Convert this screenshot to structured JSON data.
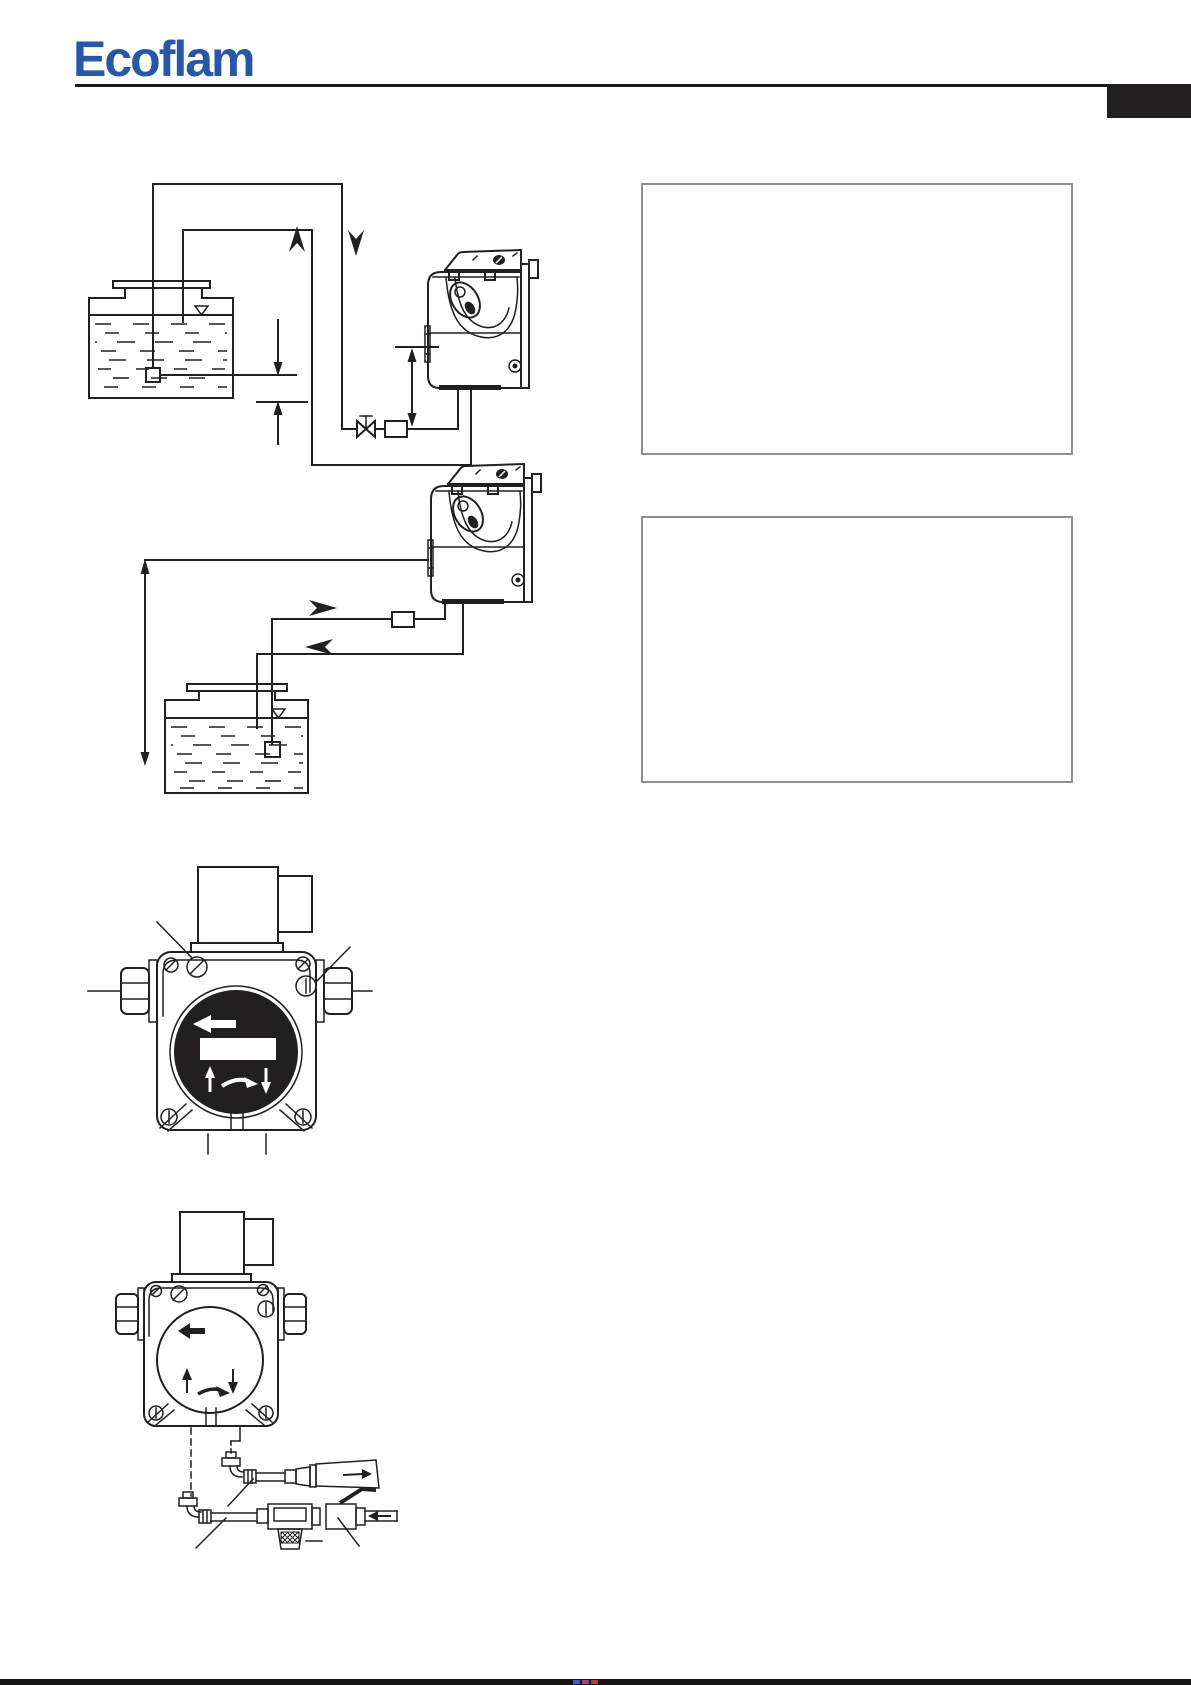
{
  "page": {
    "kind": "burner-manual-page",
    "width": 1191,
    "height": 1685,
    "background": "#ffffff"
  },
  "header": {
    "brand": "Ecoflam",
    "brand_color": "#2857a8",
    "rule_color": "#1a1a1a",
    "corner_tab_color": "#231f20"
  },
  "drawing": {
    "line_color": "#231f20"
  },
  "tables": {
    "top": {
      "corner": "",
      "header": "",
      "subheaders": [
        "",
        ""
      ],
      "body": [
        "",
        "",
        ""
      ]
    },
    "bottom": {
      "corner": "",
      "header": "",
      "subheaders": [
        "",
        ""
      ],
      "body": [
        "",
        "",
        ""
      ]
    }
  },
  "icons": {
    "flow_up_arrow": "chevron-up",
    "flow_down_arrow": "chevron-down",
    "flow_right_arrow": "chevron-right",
    "flow_left_arrow": "chevron-left",
    "oil_level_mark": "nabla-triangle",
    "shutoff_valve": "bowtie-valve",
    "line_filter": "crosshatched-rect",
    "foot_valve": "small-square",
    "dimension_arrow": "double-headed-arrow"
  },
  "print_bar": {
    "color": "#141414",
    "registration_marks": [
      "#3b5bd0",
      "#b03b8e",
      "#c23b3b"
    ]
  }
}
